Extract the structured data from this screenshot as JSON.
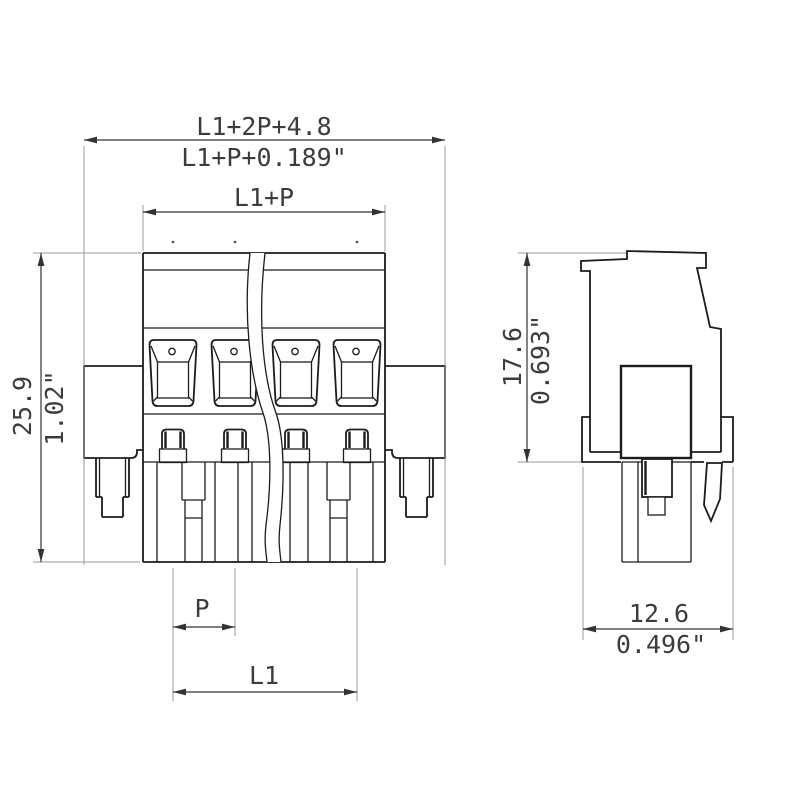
{
  "drawing": {
    "kind": "technical-dimension-drawing",
    "component": "pluggable terminal block connector",
    "poles_shown": 4,
    "views": {
      "front": {
        "name": "front view"
      },
      "side": {
        "name": "side view"
      }
    },
    "dimensions": {
      "overall_width": {
        "metric": "L1+2P+4.8",
        "imperial": "L1+P+0.189\""
      },
      "housing_width": {
        "metric": "L1+P"
      },
      "height": {
        "metric": "25.9",
        "imperial": "1.02\""
      },
      "pitch": {
        "metric": "P"
      },
      "pole_span": {
        "metric": "L1"
      },
      "side_height": {
        "metric": "17.6",
        "imperial": "0.693\""
      },
      "depth": {
        "metric": "12.6",
        "imperial": "0.496\""
      }
    },
    "colors": {
      "background": "#ffffff",
      "body_line": "#1c1c1c",
      "dimension_line": "#333333",
      "extension_line": "#9a9a9a",
      "text": "#3c3c3c"
    }
  }
}
